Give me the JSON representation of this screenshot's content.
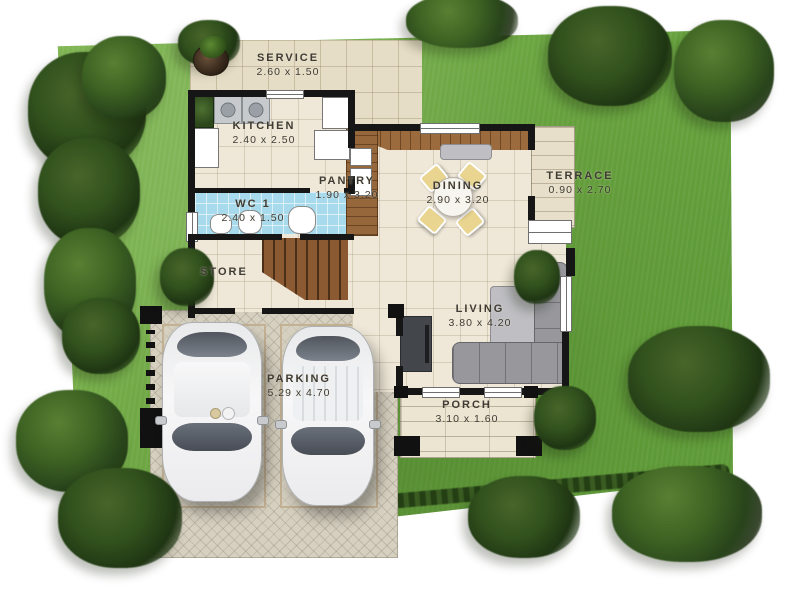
{
  "plan_title": "two-car single-storey house floor plan",
  "rooms": [
    {
      "id": "service",
      "name": "SERVICE",
      "dims": "2.60 x 1.50"
    },
    {
      "id": "kitchen",
      "name": "KITCHEN",
      "dims": "2.40 x 2.50"
    },
    {
      "id": "pantry",
      "name": "PANTRY",
      "dims": "1.90 x 3.20"
    },
    {
      "id": "dining",
      "name": "DINING",
      "dims": "2.90 x 3.20"
    },
    {
      "id": "terrace",
      "name": "TERRACE",
      "dims": "0.90 x 2.70"
    },
    {
      "id": "wc1",
      "name": "WC 1",
      "dims": "2.40 x 1.50"
    },
    {
      "id": "store",
      "name": "STORE",
      "dims": ""
    },
    {
      "id": "living",
      "name": "LIVING",
      "dims": "3.80 x 4.20"
    },
    {
      "id": "parking",
      "name": "PARKING",
      "dims": "5.29 x 4.70"
    },
    {
      "id": "porch",
      "name": "PORCH",
      "dims": "3.10 x 1.60"
    }
  ],
  "icons": {
    "tree": "green radial blob",
    "hedge": "dark green strip",
    "planter": "dark round pot with plant",
    "car": "top-view sedan / suv",
    "stairs": "wood steps with diagonal cut",
    "sofa": "gray L-sofa",
    "dining-set": "round table with four chairs",
    "sink": "steel basin square",
    "toilet": "white fixture",
    "stove": "white box with burners"
  },
  "colors": {
    "background": "#FFFFFF",
    "grass": "#6EA843",
    "tree": "#2F4E1D",
    "floor_tile": "#EFE8D8",
    "service_slab": "#E6DDC6",
    "wall": "#161616",
    "wc_floor": "#A7DAEC",
    "wood": "#8B5A33",
    "paving": "#D6D0C0",
    "chair": "#E9D58F",
    "sofa": "#97979C",
    "label_text": "#3F3B33"
  }
}
